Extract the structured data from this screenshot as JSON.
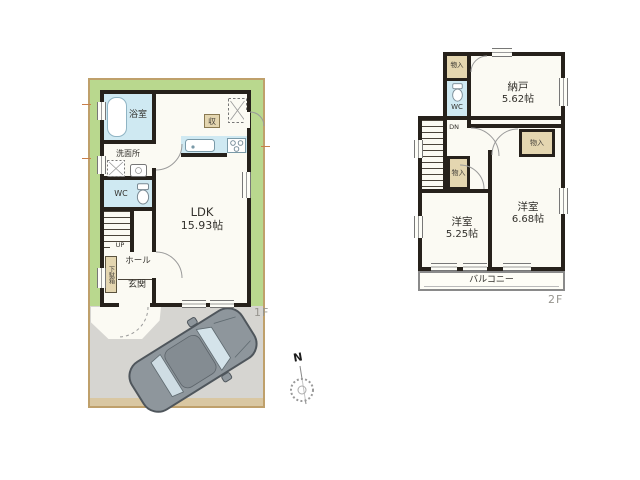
{
  "floor1": {
    "floor_label": "1F",
    "bath": "浴室",
    "washroom": "洗面所",
    "wc": "WC",
    "stairs_dir": "UP",
    "hall": "ホール",
    "entrance": "玄関",
    "shoe_cabinet": "下駄箱",
    "ldk_name": "LDK",
    "ldk_size": "15.93帖",
    "kitchen_storage": "収"
  },
  "floor2": {
    "floor_label": "2F",
    "closet_top": "物入",
    "closet_mid": "物入",
    "closet_east": "物入",
    "wc": "WC",
    "stairs_dir": "DN",
    "storeroom_name": "納戸",
    "storeroom_size": "5.62帖",
    "west_room_name": "洋室",
    "west_room_size": "5.25帖",
    "east_room_name": "洋室",
    "east_room_size": "6.68帖",
    "balcony": "バルコニー"
  },
  "compass": {
    "north_label": "N"
  },
  "colors": {
    "yard": "#b9d88e",
    "wet_area": "#cfe9f2",
    "storage": "#e4d6b0",
    "wall": "#26211b",
    "driveway": "#d6d5d1",
    "car_body": "#8e969c",
    "parcel_border": "#bfa06b"
  }
}
